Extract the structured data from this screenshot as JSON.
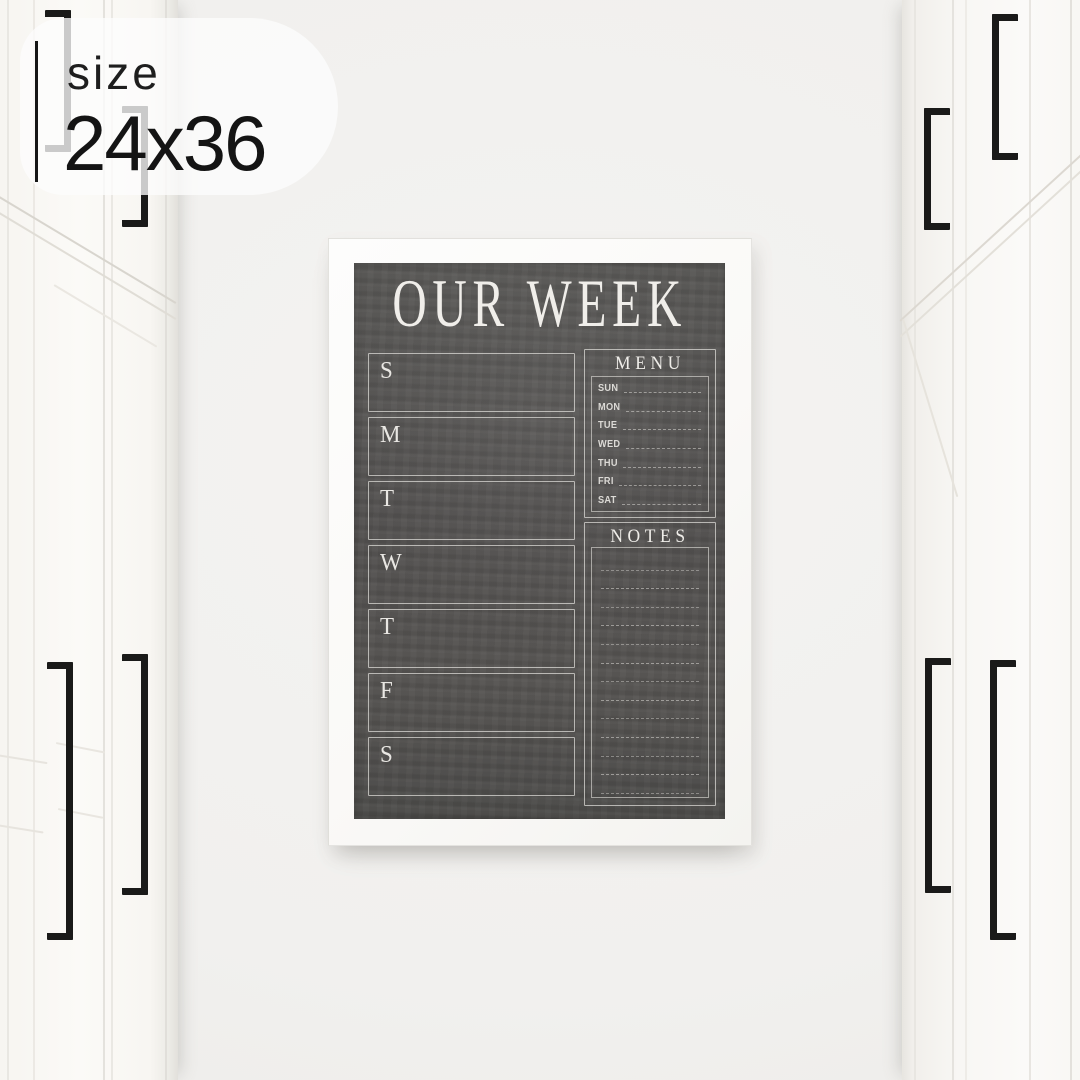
{
  "size_badge": {
    "label": "size",
    "value": "24x36"
  },
  "poster": {
    "title": "OUR WEEK",
    "day_boxes": [
      "S",
      "M",
      "T",
      "W",
      "T",
      "F",
      "S"
    ],
    "menu": {
      "title": "MENU",
      "days": [
        "SUN",
        "MON",
        "TUE",
        "WED",
        "THU",
        "FRI",
        "SAT"
      ]
    },
    "notes": {
      "title": "NOTES",
      "line_count": 13
    }
  },
  "colors": {
    "chalkboard": "#525150",
    "chalk_line": "#e6e4e0",
    "frame": "#fbfaf8",
    "wall": "#f1f0ee",
    "cabinet": "#f9f8f5",
    "handle": "#1a1a19",
    "badge_text": "#1d1d1d"
  }
}
